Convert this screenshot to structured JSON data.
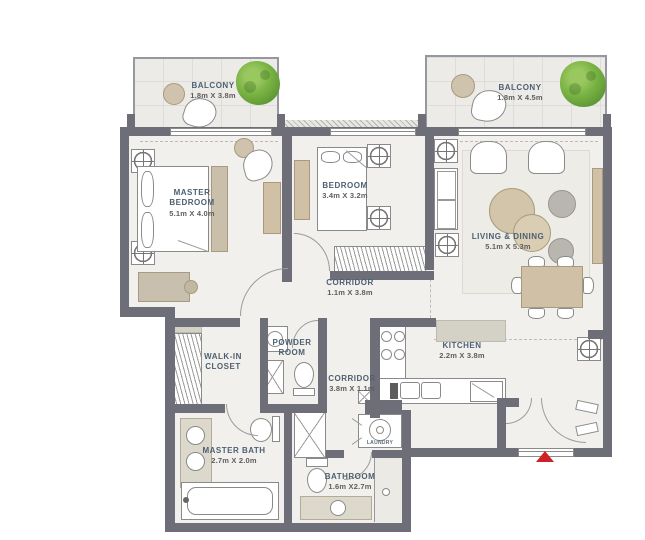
{
  "plan_title": "Apartment Floor Plan",
  "rooms": {
    "balcony_left": {
      "name": "BALCONY",
      "dims": "1.8m X 3.8m"
    },
    "balcony_right": {
      "name": "BALCONY",
      "dims": "1.8m X 4.5m"
    },
    "master_bedroom": {
      "line1": "MASTER",
      "line2": "BEDROOM",
      "dims": "5.1m X 4.0m"
    },
    "bedroom": {
      "name": "BEDROOM",
      "dims": "3.4m X 3.2m"
    },
    "living_dining": {
      "name": "LIVING & DINING",
      "dims": "5.1m X 5.3m"
    },
    "corridor_main": {
      "name": "CORRIDOR",
      "dims": "1.1m X 3.8m"
    },
    "corridor_kitchen": {
      "name": "CORRIDOR",
      "dims": "3.8m X 1.1m"
    },
    "powder_room": {
      "line1": "POWDER",
      "line2": "ROOM"
    },
    "walk_in_closet": {
      "line1": "WALK-IN",
      "line2": "CLOSET"
    },
    "kitchen": {
      "name": "KITCHEN",
      "dims": "2.2m X 3.8m"
    },
    "master_bath": {
      "name": "MASTER BATH",
      "dims": "2.7m X 2.0m"
    },
    "bathroom": {
      "name": "BATHROOM",
      "dims": "1.6m X2.7m"
    },
    "laundry": {
      "name": "LAUNDRY"
    }
  },
  "colors": {
    "wall": "#6e6e78",
    "floor": "#f2f0ec",
    "balcony_floor": "#ecebe7",
    "counter": "#d4d1c7",
    "furniture_tan": "#cfc0a6",
    "furniture_gray": "#b8b6ae",
    "tree_green": "#7ab344",
    "entry_arrow_red": "#ce2127",
    "label_blue": "#4d6072",
    "label_gray": "#5e5e5e"
  },
  "markers": {
    "entry": "entry-arrow"
  }
}
